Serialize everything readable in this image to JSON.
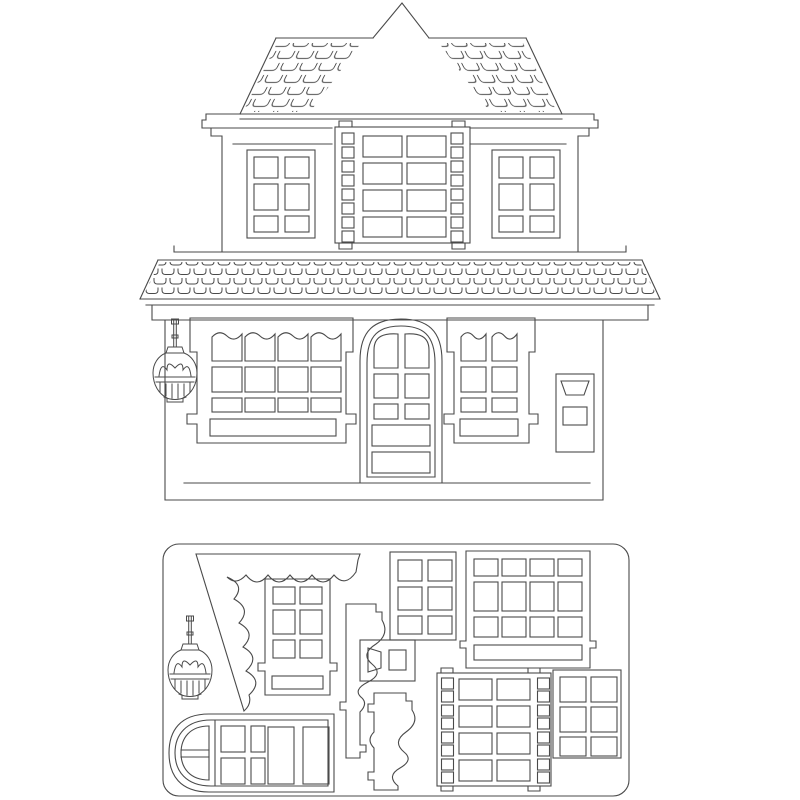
{
  "colors": {
    "background": "#ffffff",
    "line": "#4a4a4a"
  },
  "artwork": {
    "kind": "papercraft-house-line-drawing",
    "house": {
      "roof": {
        "gable_peak": true,
        "shingled_slopes": 2,
        "shingle_style": "open-top brick brackets"
      },
      "upper_floor": {
        "left_window_panes": "2x3",
        "right_window_panes": "2x3",
        "center_window_big_panes": "2x4",
        "center_window_side_squares_per_column": 8
      },
      "awning_band_shingle_rows": 3,
      "lower_floor": {
        "left_window_panes": "4 wavy-top + 4x2 + sill",
        "right_window_panes": "2 wavy-top + 2x2 + sill",
        "door": "arched, 2x3 panes + 2 panels",
        "mailbox": "flap + 1 pane",
        "lantern": "hanging, ornate cage"
      }
    },
    "sheet": {
      "shape": "rounded-rectangle die-cut sheet",
      "parts": [
        "lantern",
        "scalloped-awning-triangle",
        "window-2x3-with-sill",
        "window-2x3",
        "window-4x3-with-sill",
        "filmstrip-window-2x4-with-side-squares",
        "window-2x3-thick-frame",
        "mailbox-plate",
        "wavy-bracket-a",
        "wavy-bracket-b",
        "arched-door-rotated"
      ]
    }
  }
}
